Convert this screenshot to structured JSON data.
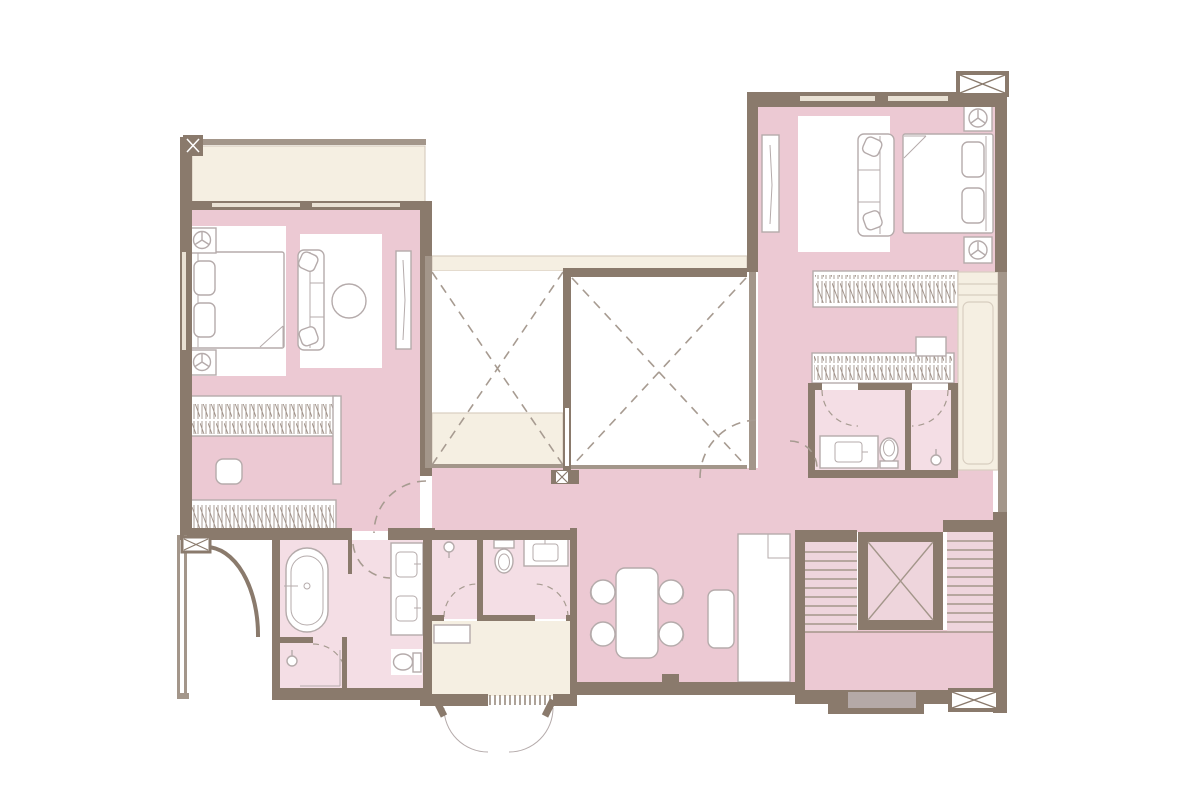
{
  "meta": {
    "type": "architectural-floor-plan",
    "view": "top-down apartment plan, no text labels visible",
    "canvas": {
      "width": 1200,
      "height": 800
    }
  },
  "colors": {
    "wall": "#8a7a6c",
    "wall2": "#a3968a",
    "pink": "#ecc9d3",
    "pinklight": "#f4dee5",
    "stairpink": "#eed5dc",
    "cream": "#f5efe2",
    "creamline": "#d8cec0",
    "fline": "#b5abab",
    "dash": "#a79b91",
    "doorgrey": "#b4a9a7",
    "bg": "#ffffff",
    "slit": "#e9e1d4"
  },
  "rooms": [
    {
      "id": "balcony",
      "floor": "cream",
      "fixtures": [
        "corner-column-x-marker",
        "railing"
      ]
    },
    {
      "id": "bedroom-1",
      "floor": "pink",
      "fixtures": [
        "double-bed",
        "pillows",
        "nightstand-with-lamp-top",
        "nightstand-with-lamp-bottom",
        "sofa",
        "round-side-table",
        "area-rug",
        "tv-console"
      ]
    },
    {
      "id": "dressing-room",
      "floor": "pink",
      "fixtures": [
        "wardrobe-hangers-top",
        "wardrobe-hangers-bottom",
        "ottoman",
        "sliding-panel"
      ]
    },
    {
      "id": "master-bathroom",
      "floor": "pink-light",
      "fixtures": [
        "freestanding-bathtub",
        "double-vanity-two-sinks",
        "shower-enclosure-with-head",
        "toilet"
      ]
    },
    {
      "id": "bathroom-2",
      "floor": "pink-light",
      "fixtures": [
        "shower-compartment-with-head",
        "toilet-with-tank",
        "vanity-sink"
      ]
    },
    {
      "id": "laundry-room",
      "floor": "cream",
      "fixtures": [
        "counter",
        "ventilation-grille",
        "double-outswing-doors"
      ]
    },
    {
      "id": "hall-dining",
      "floor": "pink",
      "fixtures": [
        "dining-table",
        "four-chairs",
        "bench-console",
        "tall-cabinet"
      ]
    },
    {
      "id": "bedroom-2",
      "floor": "pink",
      "fixtures": [
        "double-bed",
        "pillows",
        "nightstand-with-lamp-top",
        "nightstand-with-lamp-bottom",
        "sofa",
        "area-rug",
        "tv-panel",
        "wardrobe-hangers-row-1",
        "wardrobe-hangers-row-2",
        "drawer-box",
        "corner-column-x-marker"
      ]
    },
    {
      "id": "bathroom-3",
      "floor": "pink-light",
      "fixtures": [
        "vanity-sink",
        "toilet",
        "shower-compartment-with-head"
      ]
    },
    {
      "id": "closet-column",
      "floor": "cream",
      "fixtures": [
        "shelving"
      ]
    },
    {
      "id": "staircase",
      "floor": "pink",
      "fixtures": [
        "left-flight-treads",
        "right-flight-treads",
        "central-void-x-box",
        "landing",
        "entry-door-grey",
        "entry-step",
        "column-x-box"
      ]
    },
    {
      "id": "void-1",
      "floor": "white-cream",
      "fixtures": [
        "dashed-x-void-marker"
      ]
    },
    {
      "id": "void-2",
      "floor": "white",
      "fixtures": [
        "dashed-x-void-marker"
      ]
    },
    {
      "id": "terrace-edge",
      "floor": "white",
      "fixtures": [
        "curved-wall",
        "column-x-marker"
      ]
    }
  ],
  "door_swings": [
    "dressing-room-entry-dashed-arc",
    "master-bath-entry-dashed-arc",
    "bedroom-2-entry-dashed-arc",
    "corridor-bath-dashed-arc",
    "bathroom-3-door-arcs",
    "bathroom-2-compartment-arcs",
    "master-shower-arc",
    "laundry-outswing-arcs"
  ]
}
